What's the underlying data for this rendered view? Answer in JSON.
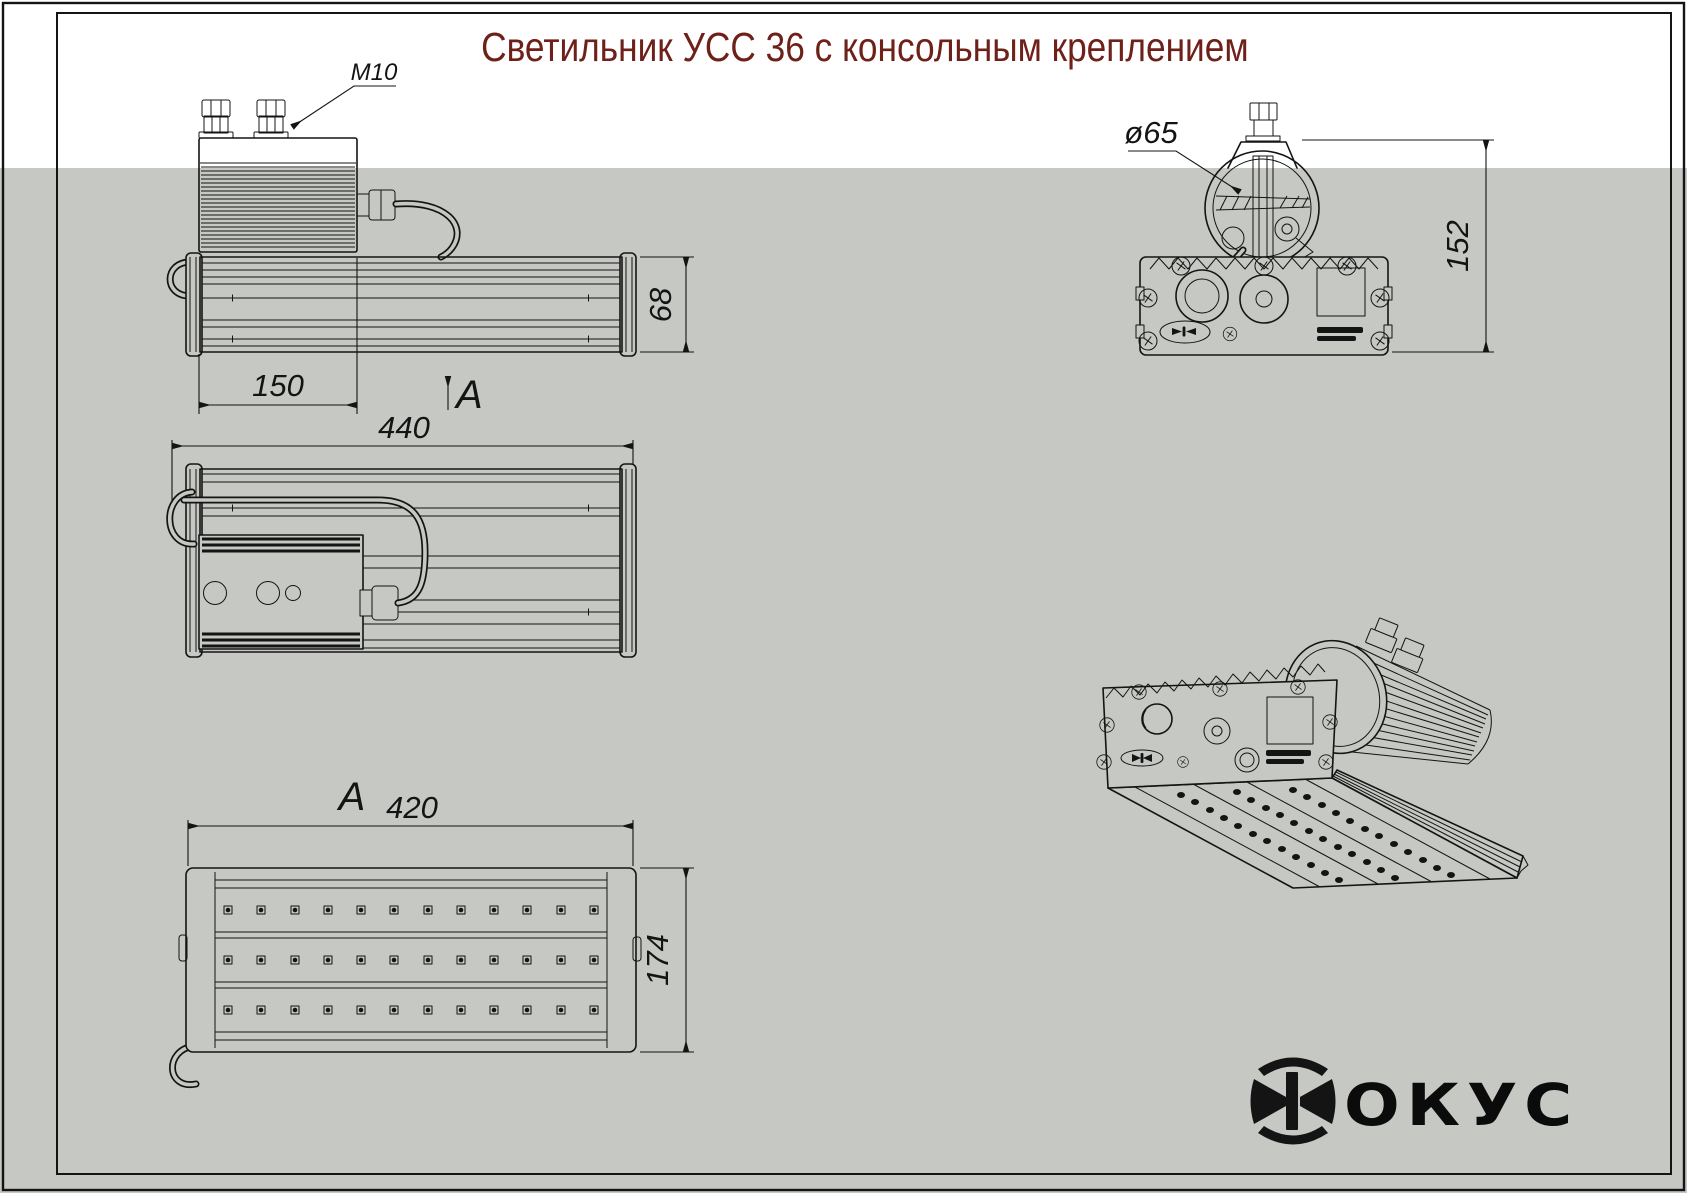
{
  "drawing": {
    "title": "Светильник УСС 36 с консольным креплением",
    "dimensions": {
      "box_length": "150",
      "overall_length": "440",
      "body_height": "68",
      "face_length": "420",
      "body_width": "174",
      "mount_height": "152"
    },
    "labels": {
      "thread": "M10",
      "clamp_diameter": "ø65",
      "section_arrow": "А",
      "view_label": "А"
    },
    "logo": {
      "symbol": "Ф",
      "text": "ОКУС"
    },
    "colors": {
      "title_text": "#6e2019",
      "paper_top": "#ffffff",
      "backdrop": "#c6c8c4",
      "ink": "#141414"
    }
  }
}
